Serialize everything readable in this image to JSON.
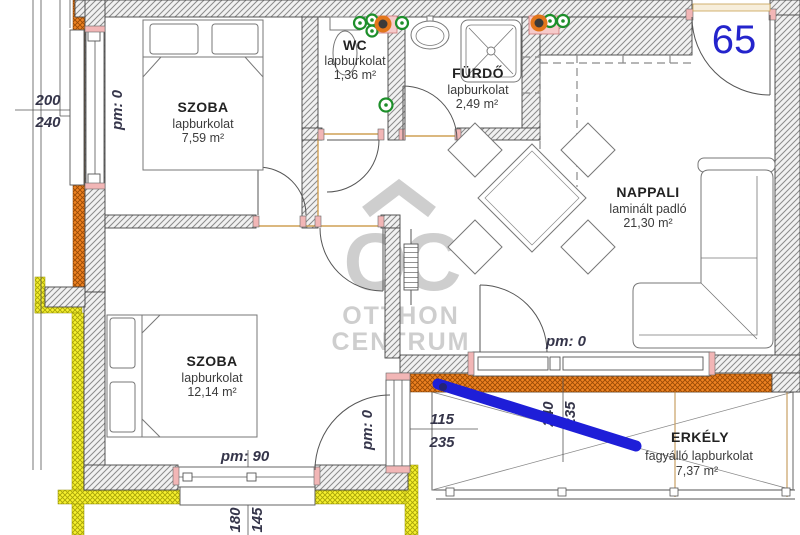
{
  "unit_label": "65",
  "watermark": {
    "monogram": "OC",
    "brand_top": "OTTHON",
    "brand_bottom": "CENTRUM"
  },
  "rooms": [
    {
      "id": "szoba1",
      "name": "SZOBA",
      "floor": "lapburkolat",
      "area": "7,59 m²"
    },
    {
      "id": "wc",
      "name": "WC",
      "floor": "lapburkolat",
      "area": "1,36 m²"
    },
    {
      "id": "furdo",
      "name": "FÜRDŐ",
      "floor": "lapburkolat",
      "area": "2,49 m²"
    },
    {
      "id": "nappali",
      "name": "NAPPALI",
      "floor": "laminált padló",
      "area": "21,30 m²"
    },
    {
      "id": "szoba2",
      "name": "SZOBA",
      "floor": "lapburkolat",
      "area": "12,14 m²"
    },
    {
      "id": "erkely",
      "name": "ERKÉLY",
      "floor": "fagyálló lapburkolat",
      "area": "7,37 m²"
    }
  ],
  "dimensions": {
    "szoba1_window": {
      "width": "200",
      "height": "240",
      "pm": "pm: 0"
    },
    "szoba2_window": {
      "pm": "pm: 90",
      "width": "180",
      "height": "145"
    },
    "szoba2_balcony_door": {
      "pm": "pm: 0",
      "width": "115",
      "height": "235"
    },
    "nappali_balcony_door": {
      "pm": "pm: 0",
      "width": "240",
      "height": "235"
    }
  },
  "colors": {
    "annotation_blue": "#1e1ed8",
    "unit_number_blue": "#2424cc",
    "insulation_orange": "#ee8222",
    "insulation_yellow": "#f7f12e",
    "watermark_gray": "#c6c6c6"
  }
}
